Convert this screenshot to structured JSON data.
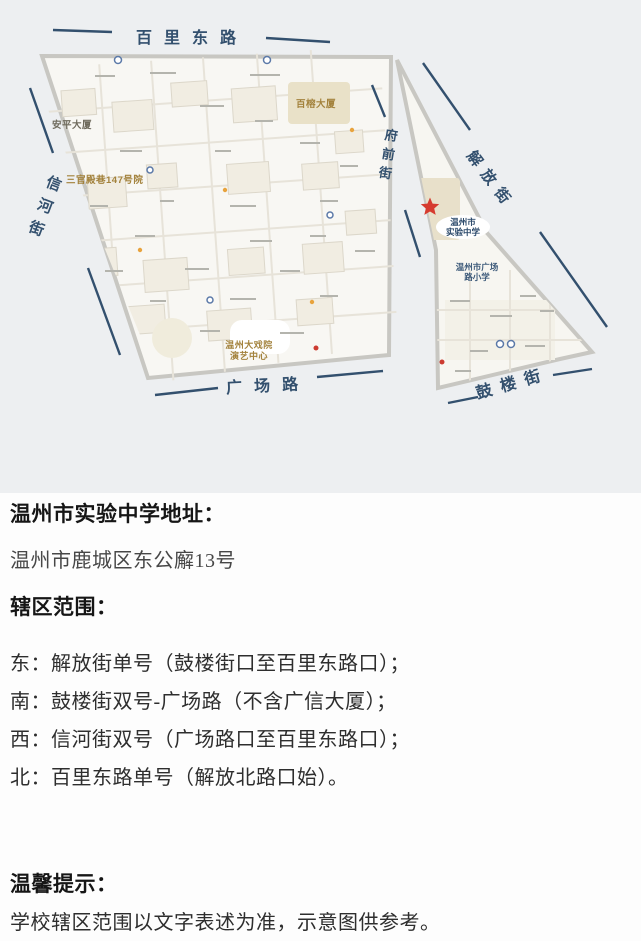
{
  "map": {
    "streets": {
      "north": "百里东路",
      "west": "信河街",
      "south": "广场路",
      "southeast": "鼓楼街",
      "middle": "府前街",
      "east": "解放街"
    },
    "landmarks": {
      "anping_building": "安平大厦",
      "sanguandian_lane": "三官殿巷147号院",
      "bairong_building": "百榕大厦",
      "theater_line1": "温州大戏院",
      "theater_line2": "演艺中心",
      "school_line1": "温州市",
      "school_line2": "实验中学",
      "primary_school_line1": "温州市广场",
      "primary_school_line2": "路小学"
    },
    "colors": {
      "street_label": "#33506e",
      "school_star": "#d63b2f",
      "landmark_gold": "#a3823c",
      "map_background": "#edeff1",
      "district_fill": "#f8f7f3"
    }
  },
  "info": {
    "address_heading": "温州市实验中学地址：",
    "address": "温州市鹿城区东公廨13号",
    "district_heading": "辖区范围：",
    "boundaries": [
      "东：解放街单号（鼓楼街口至百里东路口）；",
      "南：鼓楼街双号-广场路（不含广信大厦）；",
      "西：信河街双号（广场路口至百里东路口）；",
      "北：百里东路单号（解放北路口始）。"
    ]
  },
  "tips": {
    "heading": "温馨提示：",
    "text": "学校辖区范围以文字表述为准，示意图供参考。"
  }
}
